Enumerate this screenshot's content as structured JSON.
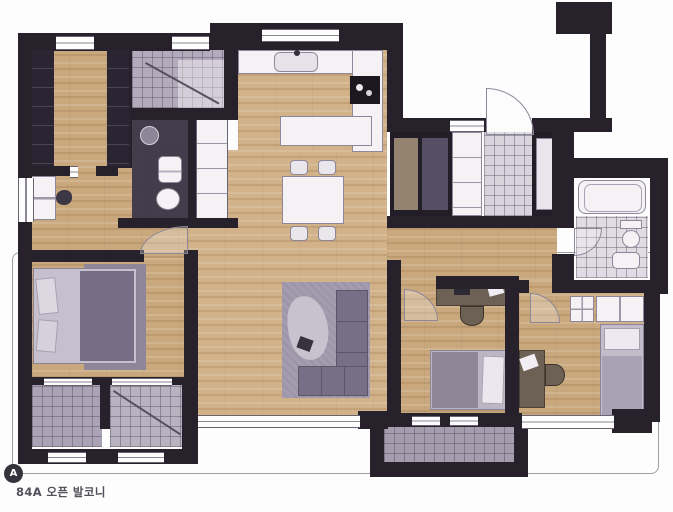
{
  "annotation": {
    "marker_letter": "A",
    "label": "84A 오픈 발코니"
  },
  "palette": {
    "wall": "#27212b",
    "wood": "#c9a87e",
    "wood_light": "#d2b289",
    "tile_gray": "#aba3b5",
    "tile_light": "#d8d3dc",
    "tile_dark": "#433c4b",
    "fixture": "#f4f2f5",
    "fixture_border": "#8f8799",
    "furniture_purple": "#938b9e",
    "furniture_purple_dark": "#776e86",
    "bed_light": "#c6bfce",
    "desk_wood": "#6d6054",
    "outline": "#9aa09e",
    "label_color": "#53525c"
  }
}
